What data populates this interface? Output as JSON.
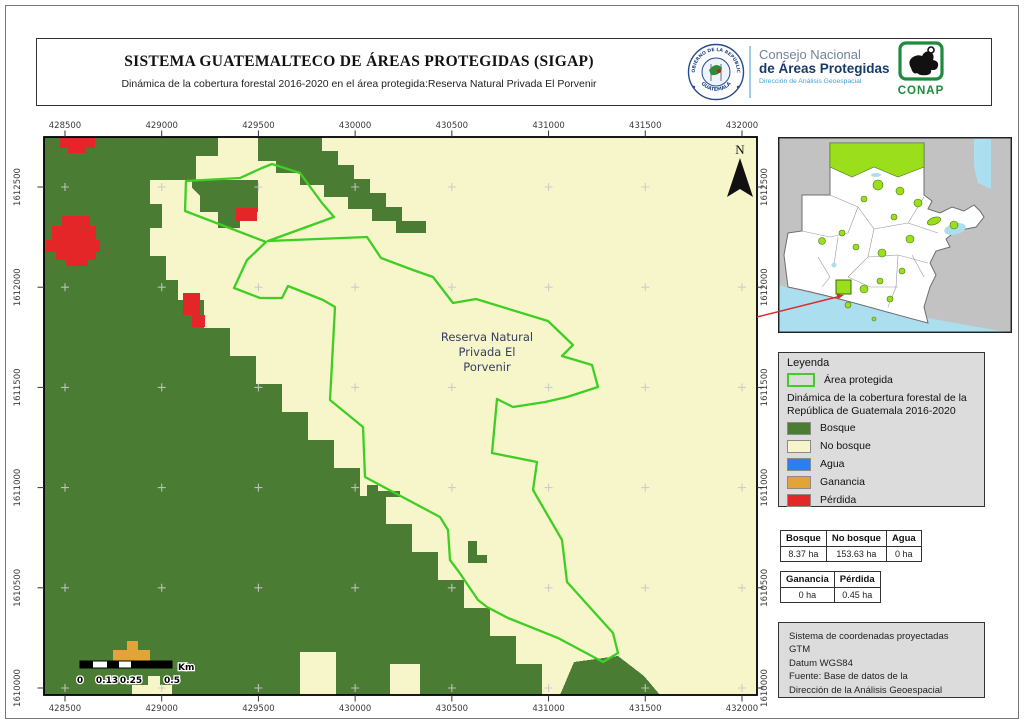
{
  "header": {
    "title": "SISTEMA GUATEMALTECO DE ÁREAS PROTEGIDAS  (SIGAP)",
    "subtitle": "Dinámica de la cobertura forestal 2016-2020 en el área protegida:Reserva Natural Privada El Porvenir"
  },
  "logos": {
    "gobierno_seal_top": "GOBIERNO DE LA REPÚBLICA",
    "gobierno_seal_bottom": "GUATEMALA",
    "consejo_line1": "Consejo Nacional",
    "consejo_line2": "de Áreas Protegidas",
    "consejo_line3": "Dirección de Análisis Geoespacial",
    "conap_label": "CONAP"
  },
  "map": {
    "north_label": "N",
    "area_label_lines": [
      "Reserva Natural",
      "Privada El",
      "Porvenir"
    ],
    "x_ticks": [
      "428500",
      "429000",
      "429500",
      "430000",
      "430500",
      "431000",
      "431500",
      "432000"
    ],
    "y_ticks": [
      "1612500",
      "1612000",
      "1611500",
      "1611000",
      "1610500",
      "1610000"
    ],
    "scalebar": {
      "labels": [
        "0",
        "0.13",
        "0.25",
        "0.5"
      ],
      "unit": "Km"
    }
  },
  "legend": {
    "title": "Leyenda",
    "area_item_label": "Área protegida",
    "dynamics_caption": "Dinámica de la cobertura forestal de la República de Guatemala 2016-2020",
    "classes": [
      {
        "label": "Bosque",
        "color": "#4a7c33"
      },
      {
        "label": "No bosque",
        "color": "#f6f6ca"
      },
      {
        "label": "Agua",
        "color": "#2e7ef2"
      },
      {
        "label": "Ganancia",
        "color": "#e2a437"
      },
      {
        "label": "Pérdida",
        "color": "#e52629"
      }
    ]
  },
  "stats": {
    "table1": {
      "headers": [
        "Bosque",
        "No bosque",
        "Agua"
      ],
      "values": [
        "8.37 ha",
        "153.63 ha",
        "0 ha"
      ]
    },
    "table2": {
      "headers": [
        "Ganancia",
        "Pérdida"
      ],
      "values": [
        "0 ha",
        "0.45 ha"
      ]
    }
  },
  "info_box": {
    "lines": [
      "Sistema de coordenadas proyectadas",
      "GTM",
      "Datum WGS84",
      "Fuente: Base de datos de la",
      "Dirección de la Análisis Geoespacial"
    ]
  },
  "colors": {
    "area_boundary": "#3fcf24",
    "bosque": "#4a7c33",
    "no_bosque": "#f6f6ca",
    "agua": "#2e7ef2",
    "ganancia": "#e2a437",
    "perdida": "#e52629",
    "inset_protected": "#9ade1c",
    "inset_water": "#abdff0"
  }
}
